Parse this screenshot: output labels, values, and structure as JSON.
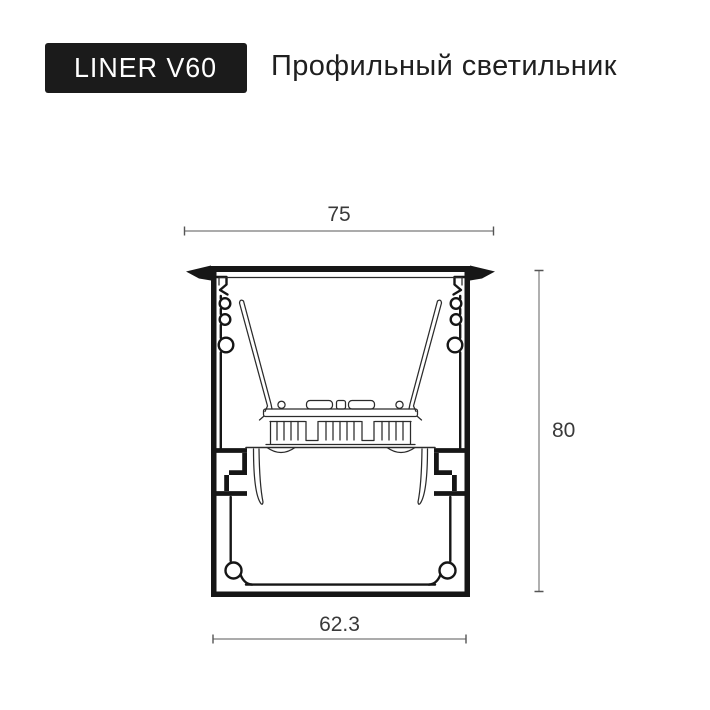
{
  "badge": {
    "label": "LINER V60"
  },
  "header": {
    "title": "Профильный светильник"
  },
  "drawing": {
    "dimensions": {
      "top_width": "75",
      "height": "80",
      "bottom_width": "62.3"
    }
  },
  "colors": {
    "background": "#ffffff",
    "badge_bg": "#1b1b1b",
    "badge_text": "#ffffff",
    "title_text": "#1f1f1f",
    "line": "#161616",
    "thin_line": "#2b2b2b",
    "dim_line": "#8f8f8f",
    "dim_text": "#3a3a3a"
  }
}
